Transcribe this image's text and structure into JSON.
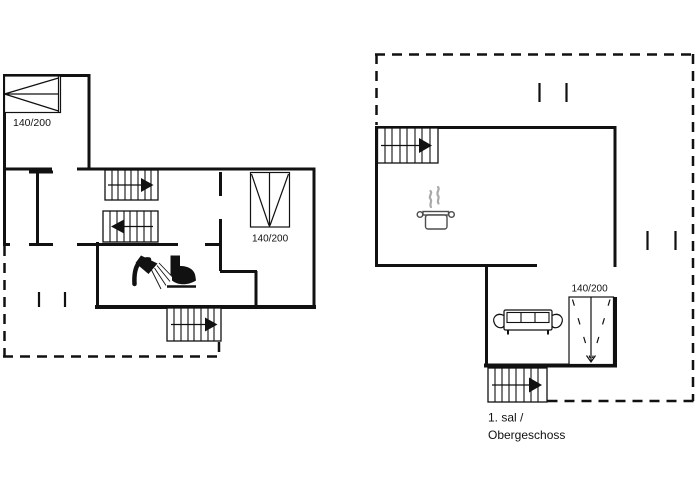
{
  "canvas": {
    "background": "#ffffff",
    "ink": "#111111"
  },
  "plans": {
    "ground": {
      "beds": {
        "top_left_label": "140/200",
        "right_room_label": "140/200"
      }
    },
    "first": {
      "bed_label": "140/200",
      "caption": {
        "line1": "1. sal /",
        "line2": "Obergeschoss"
      }
    }
  },
  "icons": {
    "steam_color": "#a9a9a9",
    "names": [
      "staircase-arrow",
      "double-bed",
      "shower-icon",
      "toilet-icon",
      "cooking-pot-icon",
      "sofa-icon",
      "window-tick"
    ]
  }
}
